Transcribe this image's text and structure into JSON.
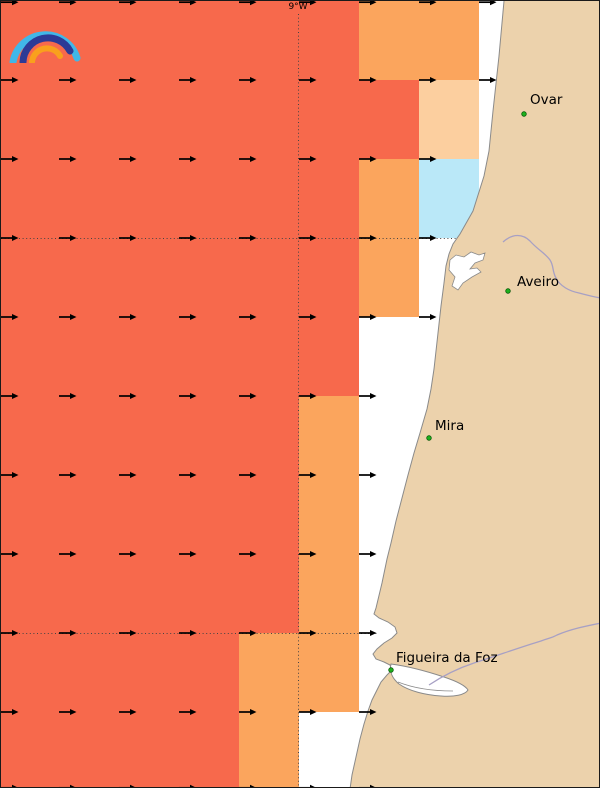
{
  "map": {
    "meridian_label": "9°W",
    "colors": {
      "salmon": "#F7694C",
      "orange": "#FBA55D",
      "peach": "#FCCF9F",
      "cyan": "#BAE8F8",
      "land": "#ECD2AC",
      "sea": "#FFFFFF",
      "coastline": "#8A8A8A",
      "river": "#A7A0C4",
      "arrow": "#000000",
      "gridline": "#444444",
      "city_dot_fill": "#1DB11D",
      "city_dot_edge": "#0A5A0A"
    },
    "grid": {
      "col_x": [
        0,
        58,
        118,
        178,
        238,
        298,
        358,
        418,
        478,
        538
      ],
      "row_y": [
        0,
        79,
        158,
        237,
        316,
        395,
        474,
        553,
        632,
        711,
        788
      ],
      "meridian_x": 297,
      "meridian_y_start": 13,
      "parallels": [
        {
          "y": 237,
          "x_start": 0,
          "x_end": 455
        },
        {
          "y": 632,
          "x_start": 0,
          "x_end": 378
        }
      ]
    },
    "cells": [
      {
        "row": 0,
        "spans": [
          {
            "col": 0,
            "ncols": 6,
            "color": "salmon"
          },
          {
            "col": 6,
            "ncols": 2,
            "color": "orange"
          }
        ]
      },
      {
        "row": 1,
        "spans": [
          {
            "col": 0,
            "ncols": 7,
            "color": "salmon"
          },
          {
            "col": 7,
            "ncols": 1,
            "color": "peach"
          }
        ]
      },
      {
        "row": 2,
        "spans": [
          {
            "col": 0,
            "ncols": 6,
            "color": "salmon"
          },
          {
            "col": 6,
            "ncols": 1,
            "color": "orange"
          },
          {
            "col": 7,
            "ncols": 1,
            "color": "cyan"
          }
        ]
      },
      {
        "row": 3,
        "spans": [
          {
            "col": 0,
            "ncols": 6,
            "color": "salmon"
          },
          {
            "col": 6,
            "ncols": 1,
            "color": "orange"
          }
        ]
      },
      {
        "row": 4,
        "spans": [
          {
            "col": 0,
            "ncols": 6,
            "color": "salmon"
          }
        ]
      },
      {
        "row": 5,
        "spans": [
          {
            "col": 0,
            "ncols": 5,
            "color": "salmon"
          },
          {
            "col": 5,
            "ncols": 1,
            "color": "orange"
          }
        ]
      },
      {
        "row": 6,
        "spans": [
          {
            "col": 0,
            "ncols": 5,
            "color": "salmon"
          },
          {
            "col": 5,
            "ncols": 1,
            "color": "orange"
          }
        ]
      },
      {
        "row": 7,
        "spans": [
          {
            "col": 0,
            "ncols": 5,
            "color": "salmon"
          },
          {
            "col": 5,
            "ncols": 1,
            "color": "orange"
          }
        ]
      },
      {
        "row": 8,
        "spans": [
          {
            "col": 0,
            "ncols": 4,
            "color": "salmon"
          },
          {
            "col": 4,
            "ncols": 2,
            "color": "orange"
          }
        ]
      },
      {
        "row": 9,
        "spans": [
          {
            "col": 0,
            "ncols": 4,
            "color": "salmon"
          },
          {
            "col": 4,
            "ncols": 1,
            "color": "orange"
          }
        ]
      }
    ],
    "wind_arrows": {
      "direction": "east",
      "rows": [
        {
          "y": 0,
          "cols": [
            0,
            1,
            2,
            3,
            4,
            5,
            6,
            7,
            8
          ]
        },
        {
          "y": 79,
          "cols": [
            0,
            1,
            2,
            3,
            4,
            5,
            6,
            7,
            8
          ]
        },
        {
          "y": 158,
          "cols": [
            0,
            1,
            2,
            3,
            4,
            5,
            6,
            7
          ]
        },
        {
          "y": 237,
          "cols": [
            0,
            1,
            2,
            3,
            4,
            5,
            6,
            7
          ]
        },
        {
          "y": 316,
          "cols": [
            0,
            1,
            2,
            3,
            4,
            5,
            6,
            7
          ]
        },
        {
          "y": 395,
          "cols": [
            0,
            1,
            2,
            3,
            4,
            5,
            6
          ]
        },
        {
          "y": 474,
          "cols": [
            0,
            1,
            2,
            3,
            4,
            5,
            6
          ]
        },
        {
          "y": 553,
          "cols": [
            0,
            1,
            2,
            3,
            4,
            5,
            6
          ]
        },
        {
          "y": 632,
          "cols": [
            0,
            1,
            2,
            3,
            4,
            5,
            6
          ]
        },
        {
          "y": 711,
          "cols": [
            0,
            1,
            2,
            3,
            4,
            5,
            6
          ]
        },
        {
          "y": 788,
          "cols": [
            0,
            1,
            2,
            3,
            4,
            5,
            6
          ]
        }
      ]
    },
    "cities": [
      {
        "name": "Ovar",
        "dot": {
          "x": 523,
          "y": 113
        },
        "label": {
          "x": 529,
          "y": 93
        }
      },
      {
        "name": "Aveiro",
        "dot": {
          "x": 507,
          "y": 290
        },
        "label": {
          "x": 516,
          "y": 275
        }
      },
      {
        "name": "Mira",
        "dot": {
          "x": 428,
          "y": 437
        },
        "label": {
          "x": 434,
          "y": 419
        }
      },
      {
        "name": "Figueira da Foz",
        "dot": {
          "x": 390,
          "y": 669
        },
        "label": {
          "x": 395,
          "y": 651
        }
      }
    ]
  },
  "logo": {
    "name": "rainbow-arcs-logo",
    "arc_colors": {
      "outer": "#41B7E8",
      "middle": "#2D3A96",
      "inner": "#F9A01D"
    }
  }
}
